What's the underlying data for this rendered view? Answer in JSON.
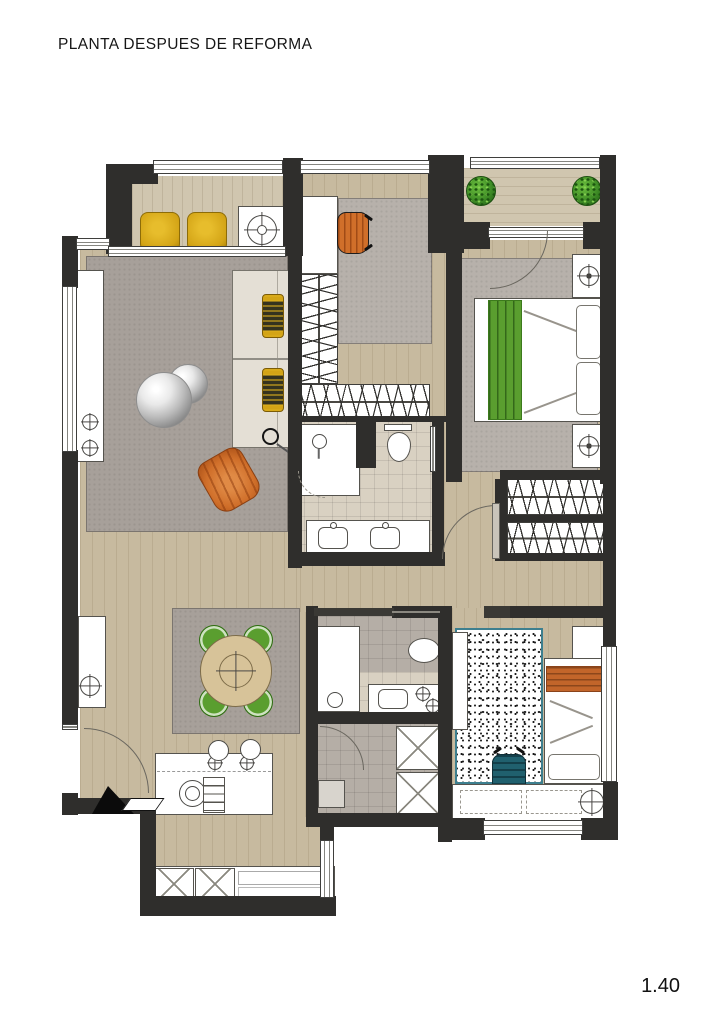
{
  "title": "PLANTA DESPUES DE REFORMA",
  "scale_label": "1.40",
  "palette": {
    "wall": "#2f2e2c",
    "wood": "#c7ba9f",
    "deck": "#d0c6af",
    "rug": "#a7a09a",
    "rug_light": "#b7b1ab",
    "tile_beige": "#d9d1c2",
    "tile_gray": "#b5aea6",
    "sofa": "#e4dfd5",
    "yellow": "#d3a416",
    "orange": "#d06f2a",
    "green": "#5a9e2f",
    "teal": "#20606e",
    "plant": "#3f8d26",
    "bed_orange": "#c2652a",
    "line": "#55534e"
  },
  "symbols": {
    "crosshair-icon": "circle with cross ticks (lamp / faucet / decor)",
    "hanger-hatch": "slanted line hatching = closet hangers",
    "x-box": "crossed square = cabinet / tall unit",
    "door-arc": "quarter-circle door swing",
    "entrance-arrow": "black arrow marking apartment entry"
  }
}
